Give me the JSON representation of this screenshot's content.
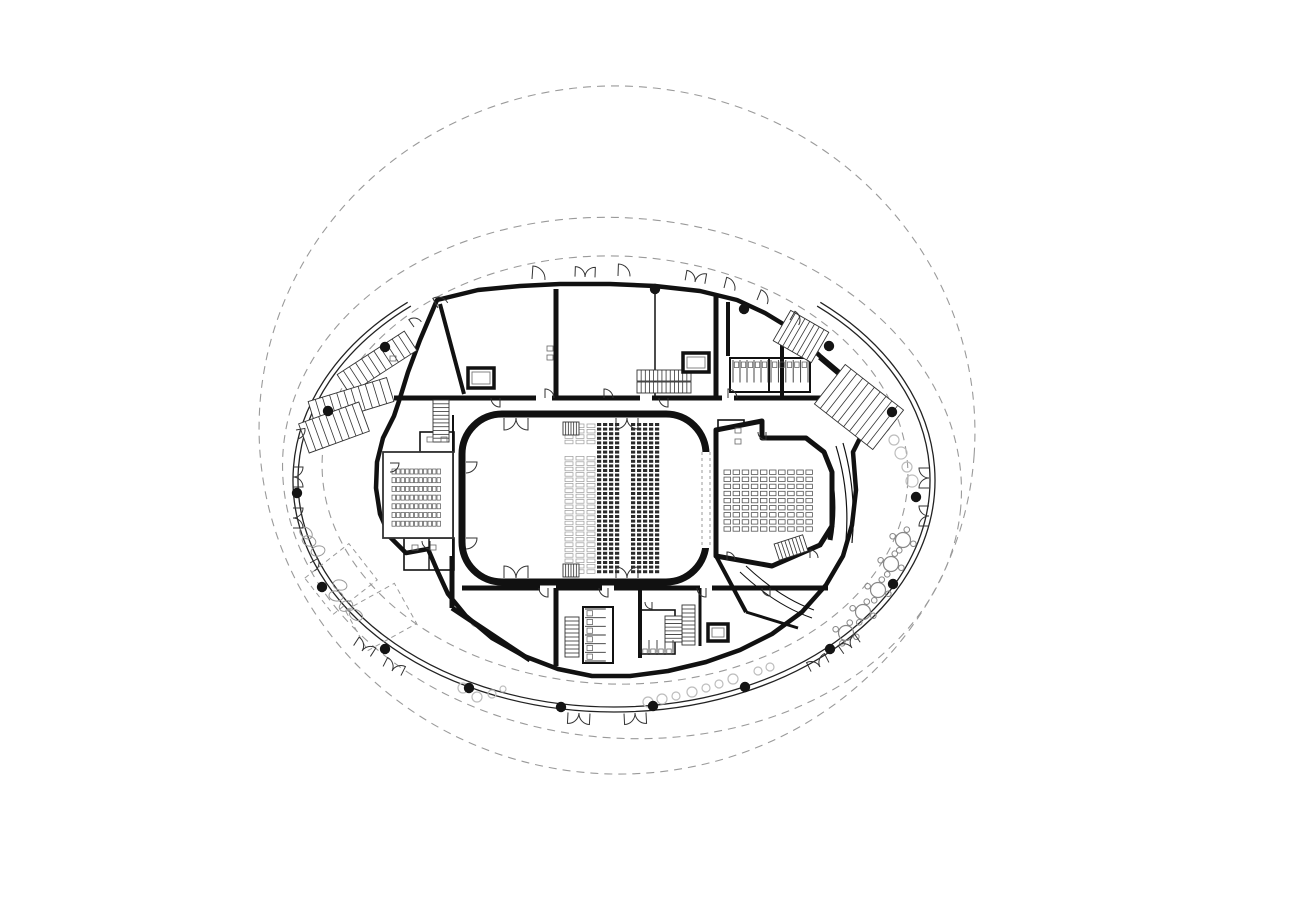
{
  "canvas": {
    "w": 1300,
    "h": 919,
    "bg": "#ffffff"
  },
  "palette": {
    "ink": "#141414",
    "wall": "#111111",
    "grey": "#8d8d8d",
    "light": "#bdbdbd",
    "dash": "#9a9a9a",
    "seat_dark": "#2b2b2b",
    "seat_light": "#9a9a9a"
  },
  "roof_outlines": [
    {
      "cx": 617,
      "cy": 430,
      "rx": 358,
      "ry": 344,
      "rot": 4
    },
    {
      "cx": 622,
      "cy": 478,
      "rx": 340,
      "ry": 260,
      "rot": 5
    },
    {
      "cx": 615,
      "cy": 470,
      "rx": 293,
      "ry": 214,
      "rot": 2
    }
  ],
  "facade": {
    "cx": 614,
    "cy": 480,
    "arcs": [
      {
        "rx": 321,
        "ry": 232
      },
      {
        "rx": 316,
        "ry": 227
      }
    ],
    "start_deg": 230,
    "end_deg": 310
  },
  "building_outline": [
    [
      437,
      300
    ],
    [
      478,
      290
    ],
    [
      520,
      286
    ],
    [
      560,
      284
    ],
    [
      610,
      284
    ],
    [
      655,
      286
    ],
    [
      700,
      291
    ],
    [
      737,
      300
    ],
    [
      765,
      313
    ],
    [
      793,
      330
    ],
    [
      820,
      356
    ],
    [
      847,
      380
    ],
    [
      863,
      402
    ],
    [
      868,
      420
    ],
    [
      860,
      438
    ],
    [
      853,
      452
    ],
    [
      856,
      490
    ],
    [
      852,
      525
    ],
    [
      843,
      556
    ],
    [
      826,
      585
    ],
    [
      802,
      612
    ],
    [
      772,
      634
    ],
    [
      740,
      650
    ],
    [
      706,
      662
    ],
    [
      668,
      671
    ],
    [
      630,
      676
    ],
    [
      592,
      676
    ],
    [
      558,
      669
    ],
    [
      524,
      656
    ],
    [
      492,
      638
    ],
    [
      466,
      616
    ],
    [
      448,
      594
    ],
    [
      437,
      570
    ],
    [
      428,
      549
    ],
    [
      406,
      553
    ],
    [
      390,
      537
    ],
    [
      380,
      514
    ],
    [
      376,
      488
    ],
    [
      377,
      462
    ],
    [
      383,
      438
    ],
    [
      394,
      416
    ],
    [
      400,
      398
    ],
    [
      408,
      372
    ],
    [
      420,
      340
    ]
  ],
  "main_hall": {
    "x": 462,
    "y": 414,
    "w": 244,
    "h": 168,
    "r": 40,
    "wall": 7,
    "gap": {
      "x": 697,
      "y": 452,
      "w": 17,
      "h": 96
    },
    "dashed_lines": [
      [
        702,
        452,
        702,
        548
      ],
      [
        710,
        452,
        710,
        548
      ]
    ]
  },
  "second_hall": {
    "points": [
      [
        716,
        430
      ],
      [
        762,
        421
      ],
      [
        762,
        438
      ],
      [
        806,
        438
      ],
      [
        824,
        452
      ],
      [
        832,
        472
      ],
      [
        832,
        526
      ],
      [
        820,
        545
      ],
      [
        772,
        566
      ],
      [
        716,
        556
      ]
    ],
    "wall": 5
  },
  "left_room": {
    "x": 383,
    "y": 452,
    "w": 70,
    "h": 86,
    "sw": 1.8
  },
  "rooms": [
    [
      420,
      432,
      34,
      20,
      1.6
    ],
    [
      404,
      538,
      50,
      32,
      1.6
    ],
    [
      730,
      358,
      80,
      34,
      2
    ],
    [
      718,
      420,
      26,
      24,
      1.6
    ],
    [
      583,
      607,
      30,
      56,
      2
    ],
    [
      641,
      610,
      34,
      44,
      1.6
    ]
  ],
  "room_dividers": [
    [
      429,
      538,
      429,
      570,
      1.4
    ],
    [
      769,
      358,
      769,
      392,
      2
    ],
    [
      718,
      432,
      744,
      432,
      1
    ]
  ],
  "walls": [
    [
      556,
      289,
      556,
      398,
      5
    ],
    [
      655,
      288,
      655,
      396,
      1.5
    ],
    [
      716,
      295,
      716,
      398,
      5
    ],
    [
      394,
      398,
      536,
      398,
      5
    ],
    [
      552,
      398,
      640,
      398,
      5
    ],
    [
      652,
      398,
      722,
      398,
      5
    ],
    [
      734,
      398,
      838,
      398,
      5
    ],
    [
      440,
      304,
      464,
      394,
      4
    ],
    [
      782,
      332,
      782,
      398,
      4
    ],
    [
      820,
      357,
      858,
      389,
      6
    ],
    [
      462,
      588,
      540,
      588,
      5
    ],
    [
      556,
      588,
      602,
      588,
      5
    ],
    [
      614,
      588,
      700,
      588,
      5
    ],
    [
      712,
      588,
      828,
      588,
      5
    ],
    [
      556,
      588,
      556,
      666,
      5
    ],
    [
      640,
      588,
      640,
      658,
      4
    ],
    [
      700,
      588,
      700,
      646,
      3
    ],
    [
      452,
      556,
      452,
      608,
      5
    ],
    [
      452,
      608,
      530,
      660,
      5
    ],
    [
      716,
      556,
      746,
      612,
      4
    ],
    [
      746,
      612,
      798,
      628,
      3
    ],
    [
      453,
      415,
      453,
      585,
      2
    ],
    [
      728,
      302,
      728,
      356,
      4
    ]
  ],
  "wall_paths": [
    [
      "M824,452 Q838,495 830,540",
      5
    ],
    [
      "M836,446 Q850,492 846,540",
      1.2
    ],
    [
      "M843,443 Q857,492 852,543",
      1.2
    ],
    [
      "M740,572 Q775,605 812,618",
      1
    ],
    [
      "M746,566 Q780,598 814,610",
      1
    ]
  ],
  "stairs": [
    [
      637,
      370,
      54,
      11,
      0,
      13,
      "v"
    ],
    [
      637,
      382,
      54,
      11,
      0,
      13,
      "v"
    ],
    [
      433,
      400,
      16,
      42,
      0,
      11,
      "h"
    ],
    [
      337,
      351,
      80,
      23,
      -33,
      11,
      "v"
    ],
    [
      310,
      389,
      82,
      25,
      -17,
      11,
      "v"
    ],
    [
      302,
      412,
      64,
      31,
      -20,
      9,
      "v"
    ],
    [
      779,
      319,
      44,
      35,
      30,
      8,
      "v"
    ],
    [
      822,
      382,
      74,
      50,
      38,
      10,
      "v"
    ],
    [
      682,
      605,
      13,
      40,
      0,
      10,
      "h"
    ],
    [
      665,
      616,
      17,
      26,
      0,
      7,
      "h"
    ],
    [
      565,
      617,
      14,
      40,
      0,
      10,
      "h"
    ],
    [
      776,
      539,
      30,
      17,
      -18,
      8,
      "v"
    ],
    [
      563,
      422,
      16,
      13,
      0,
      6,
      "v"
    ],
    [
      563,
      564,
      16,
      13,
      0,
      6,
      "v"
    ]
  ],
  "toilets": [
    [
      733,
      360,
      35,
      30,
      5,
      "down"
    ],
    [
      771,
      360,
      37,
      30,
      5,
      "down"
    ],
    [
      585,
      609,
      26,
      52,
      6,
      "right"
    ],
    [
      641,
      640,
      32,
      17,
      4,
      "up"
    ]
  ],
  "shafts": [
    [
      683,
      353,
      26,
      19
    ],
    [
      708,
      624,
      20,
      17
    ],
    [
      468,
      368,
      26,
      20
    ]
  ],
  "fixtures": [
    [
      427,
      437
    ],
    [
      441,
      437
    ],
    [
      412,
      545
    ],
    [
      430,
      545
    ],
    [
      547,
      346
    ],
    [
      547,
      355
    ],
    [
      735,
      428
    ],
    [
      735,
      439
    ],
    [
      390,
      356
    ]
  ],
  "seating": {
    "hall_light_strips": {
      "xs": [
        565,
        576,
        587
      ],
      "y0": 424,
      "y1": 570,
      "step": 5.4,
      "w": 8,
      "h": 3.6,
      "aisle": [
        441,
        453
      ]
    },
    "hall_dark_strips": {
      "xs": [
        597,
        603,
        609,
        615,
        631,
        637,
        643,
        649,
        655
      ],
      "y0": 423,
      "y1": 573,
      "step": 4.6,
      "w": 4.2,
      "h": 3
    },
    "second_hall_rows": {
      "x0": 724,
      "x1": 806,
      "xstep": 9.1,
      "y0": 470,
      "y1": 528,
      "ystep": 7.1,
      "w": 6.5,
      "h": 4.4
    },
    "left_room_rows": {
      "x0": 392,
      "x1": 437,
      "xstep": 4.5,
      "y0": 469,
      "y1": 522,
      "ystep": 8.7,
      "w": 3.5,
      "h": 5
    }
  },
  "doors": [
    [
      532,
      279,
      13,
      4,
      0
    ],
    [
      585,
      277,
      10,
      2,
      1
    ],
    [
      618,
      276,
      12,
      2,
      0
    ],
    [
      695,
      282,
      10,
      10,
      1
    ],
    [
      724,
      288,
      11,
      14,
      0
    ],
    [
      757,
      300,
      11,
      22,
      0
    ],
    [
      790,
      320,
      10,
      30,
      0
    ],
    [
      438,
      308,
      11,
      -28,
      0
    ],
    [
      414,
      327,
      9,
      -35,
      0
    ],
    [
      579,
      713,
      11,
      183,
      1
    ],
    [
      635,
      713,
      11,
      177,
      1
    ],
    [
      362,
      651,
      10,
      33,
      1
    ],
    [
      392,
      671,
      10,
      27,
      1
    ],
    [
      820,
      667,
      10,
      -27,
      1
    ],
    [
      852,
      648,
      10,
      -35,
      1
    ],
    [
      929,
      478,
      10,
      270,
      1
    ],
    [
      929,
      516,
      10,
      270,
      1
    ],
    [
      293,
      477,
      10,
      90,
      1
    ],
    [
      293,
      518,
      10,
      90,
      1
    ],
    [
      296,
      430,
      9,
      80,
      0
    ],
    [
      310,
      563,
      9,
      60,
      0
    ],
    [
      516,
      418,
      12,
      180,
      1
    ],
    [
      627,
      418,
      11,
      180,
      1
    ],
    [
      516,
      578,
      12,
      0,
      1
    ],
    [
      627,
      578,
      11,
      0,
      1
    ],
    [
      545,
      398,
      9,
      0,
      0
    ],
    [
      604,
      398,
      9,
      0,
      0
    ],
    [
      668,
      398,
      9,
      180,
      0
    ],
    [
      728,
      398,
      9,
      0,
      0
    ],
    [
      500,
      398,
      9,
      180,
      0
    ],
    [
      548,
      588,
      9,
      180,
      0
    ],
    [
      608,
      588,
      9,
      180,
      0
    ],
    [
      706,
      588,
      9,
      180,
      0
    ],
    [
      770,
      588,
      8,
      180,
      0
    ],
    [
      390,
      463,
      9,
      90,
      0
    ],
    [
      430,
      541,
      8,
      180,
      0
    ],
    [
      766,
      432,
      8,
      180,
      0
    ],
    [
      810,
      558,
      8,
      0,
      0
    ],
    [
      727,
      560,
      8,
      0,
      0
    ],
    [
      652,
      602,
      7,
      180,
      0
    ],
    [
      466,
      462,
      11,
      90,
      0
    ],
    [
      466,
      538,
      11,
      90,
      0
    ]
  ],
  "columns": [
    [
      385,
      347
    ],
    [
      328,
      411
    ],
    [
      297,
      493
    ],
    [
      322,
      587
    ],
    [
      385,
      649
    ],
    [
      469,
      688
    ],
    [
      561,
      707
    ],
    [
      653,
      706
    ],
    [
      745,
      687
    ],
    [
      830,
      649
    ],
    [
      893,
      584
    ],
    [
      916,
      497
    ],
    [
      892,
      412
    ],
    [
      829,
      346
    ],
    [
      744,
      309
    ],
    [
      655,
      289
    ]
  ],
  "tables": [
    [
      903,
      540
    ],
    [
      891,
      564
    ],
    [
      878,
      590
    ],
    [
      863,
      612
    ],
    [
      846,
      633
    ]
  ],
  "light_circles": [
    [
      463,
      688,
      5
    ],
    [
      477,
      697,
      5
    ],
    [
      492,
      694,
      4
    ],
    [
      503,
      689,
      3
    ],
    [
      648,
      702,
      5
    ],
    [
      662,
      699,
      5
    ],
    [
      676,
      696,
      4
    ],
    [
      692,
      692,
      5
    ],
    [
      706,
      688,
      4
    ],
    [
      719,
      684,
      4
    ],
    [
      733,
      679,
      5
    ],
    [
      758,
      671,
      4
    ],
    [
      770,
      667,
      4
    ],
    [
      884,
      426,
      6
    ],
    [
      894,
      440,
      5
    ],
    [
      901,
      453,
      6
    ],
    [
      907,
      467,
      5
    ],
    [
      912,
      481,
      6
    ]
  ],
  "plants": [
    [
      309,
      541,
      20
    ],
    [
      318,
      551,
      -15
    ],
    [
      306,
      533,
      40
    ],
    [
      336,
      596,
      10
    ],
    [
      346,
      606,
      -25
    ],
    [
      356,
      615,
      30
    ],
    [
      478,
      622,
      0
    ],
    [
      340,
      585,
      15
    ]
  ],
  "dashed_rects": [
    [
      341,
      579,
      56,
      46,
      -38
    ],
    [
      381,
      617,
      56,
      46,
      -29
    ]
  ]
}
